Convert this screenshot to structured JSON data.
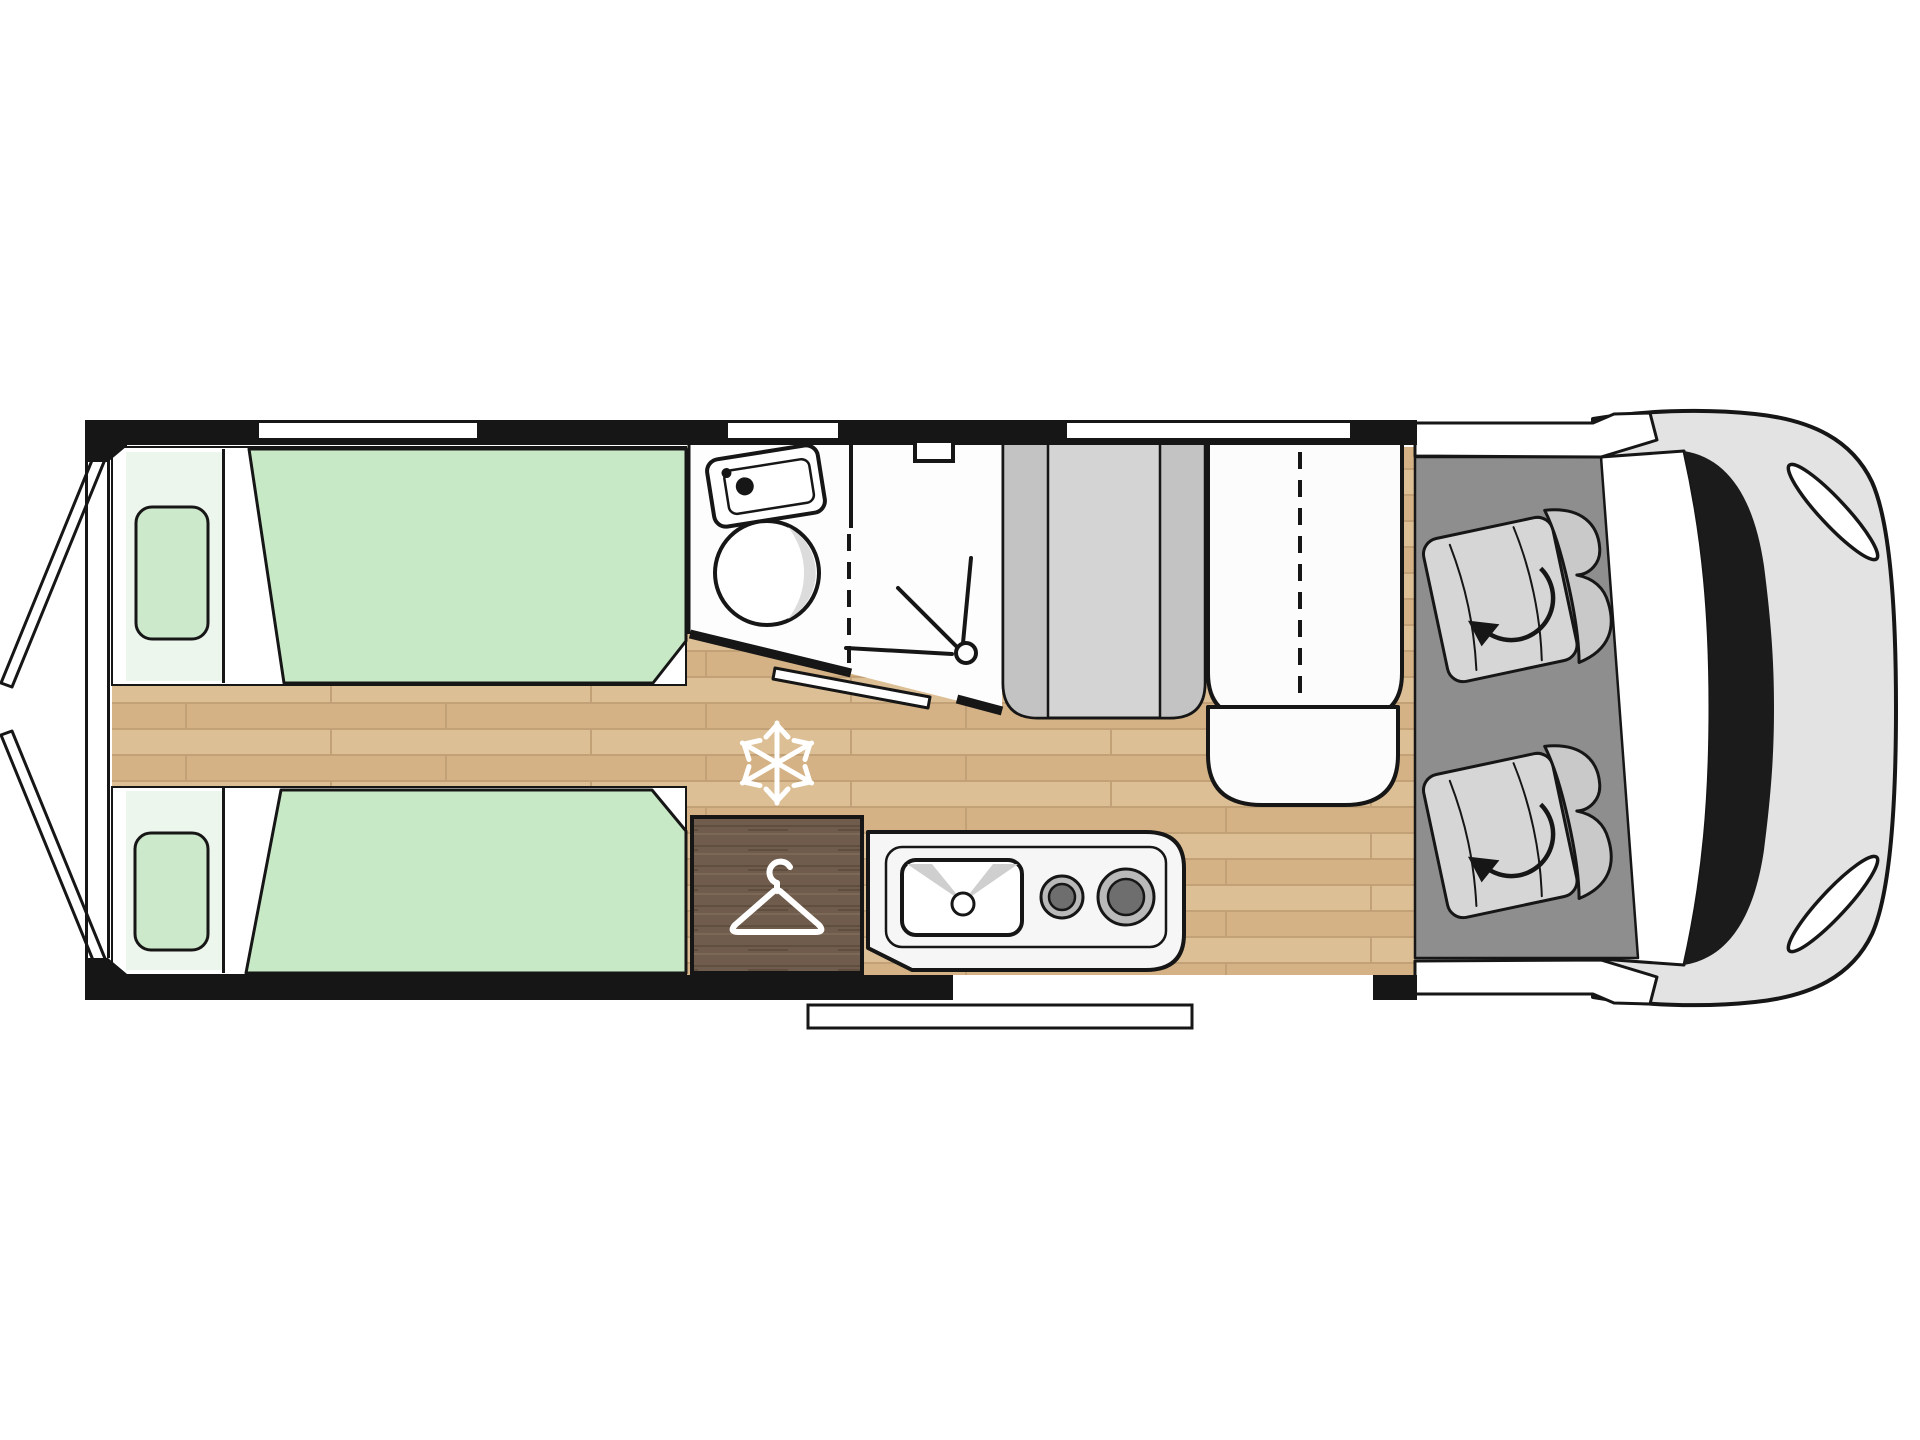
{
  "title": "Campervan floor plan, top view",
  "colors": {
    "page": "#ffffff",
    "stroke": "#161616",
    "wall": "#161616",
    "white": "#ffffff",
    "bath": "#fdfdfd",
    "bedGreen": "#c8e9c6",
    "bedHead": "#edf6ed",
    "pillow": "#cde9cb",
    "wood1": "#ddbf96",
    "wood2": "#d4b285",
    "woodLine": "#c2a176",
    "wardrobe1": "#6f5c4c",
    "wardrobe2": "#604e3e",
    "wardrobe3": "#7b6857",
    "benchLight": "#d4d4d4",
    "benchMid": "#c3c3c3",
    "seatWhite": "#fcfcfc",
    "counter": "#f6f6f6",
    "burnerRing": "#b9b9b9",
    "burnerCore": "#6e6e6e",
    "sinkWedge": "#cfcfcf",
    "cabFloor": "#8e8e8e",
    "capSeat": "#d6d6d6",
    "capSeatBack": "#c9c9c9",
    "hood": "#e3e3e3",
    "windshieldBand": "#1b1b1b",
    "shine": "#dcdcdc",
    "iconWhite": "#ffffff"
  },
  "zones": [
    {
      "id": "rear-doors",
      "kind": "open rear barn doors"
    },
    {
      "id": "twin-bed-upper",
      "kind": "single bed with pillow"
    },
    {
      "id": "twin-bed-lower",
      "kind": "single bed with pillow"
    },
    {
      "id": "center-walkway",
      "kind": "wood floor aisle"
    },
    {
      "id": "washroom",
      "kind": "vanity sink and round basin"
    },
    {
      "id": "shower",
      "kind": "shower cubicle with roof vent"
    },
    {
      "id": "wardrobe",
      "kind": "wardrobe with hanger icon"
    },
    {
      "id": "refrigerator",
      "kind": "snowflake marker on floor"
    },
    {
      "id": "kitchen",
      "kind": "counter with sink and two burners"
    },
    {
      "id": "dinette-gray-bench",
      "kind": "upholstered bench"
    },
    {
      "id": "dinette-white-bench",
      "kind": "two-seat travel bench"
    },
    {
      "id": "entry-door-step",
      "kind": "side entry with exterior step"
    },
    {
      "id": "cab",
      "kind": "two swivel captain seats"
    },
    {
      "id": "vehicle-front",
      "kind": "cab hood, windshield, headlights"
    }
  ],
  "icons": [
    {
      "name": "snowflake-icon"
    },
    {
      "name": "hanger-icon"
    },
    {
      "name": "shower-head-icon"
    },
    {
      "name": "swivel-arrow-icon"
    }
  ],
  "windows": {
    "top_wall_slots": 3,
    "bottom_wall_slots": 0
  }
}
